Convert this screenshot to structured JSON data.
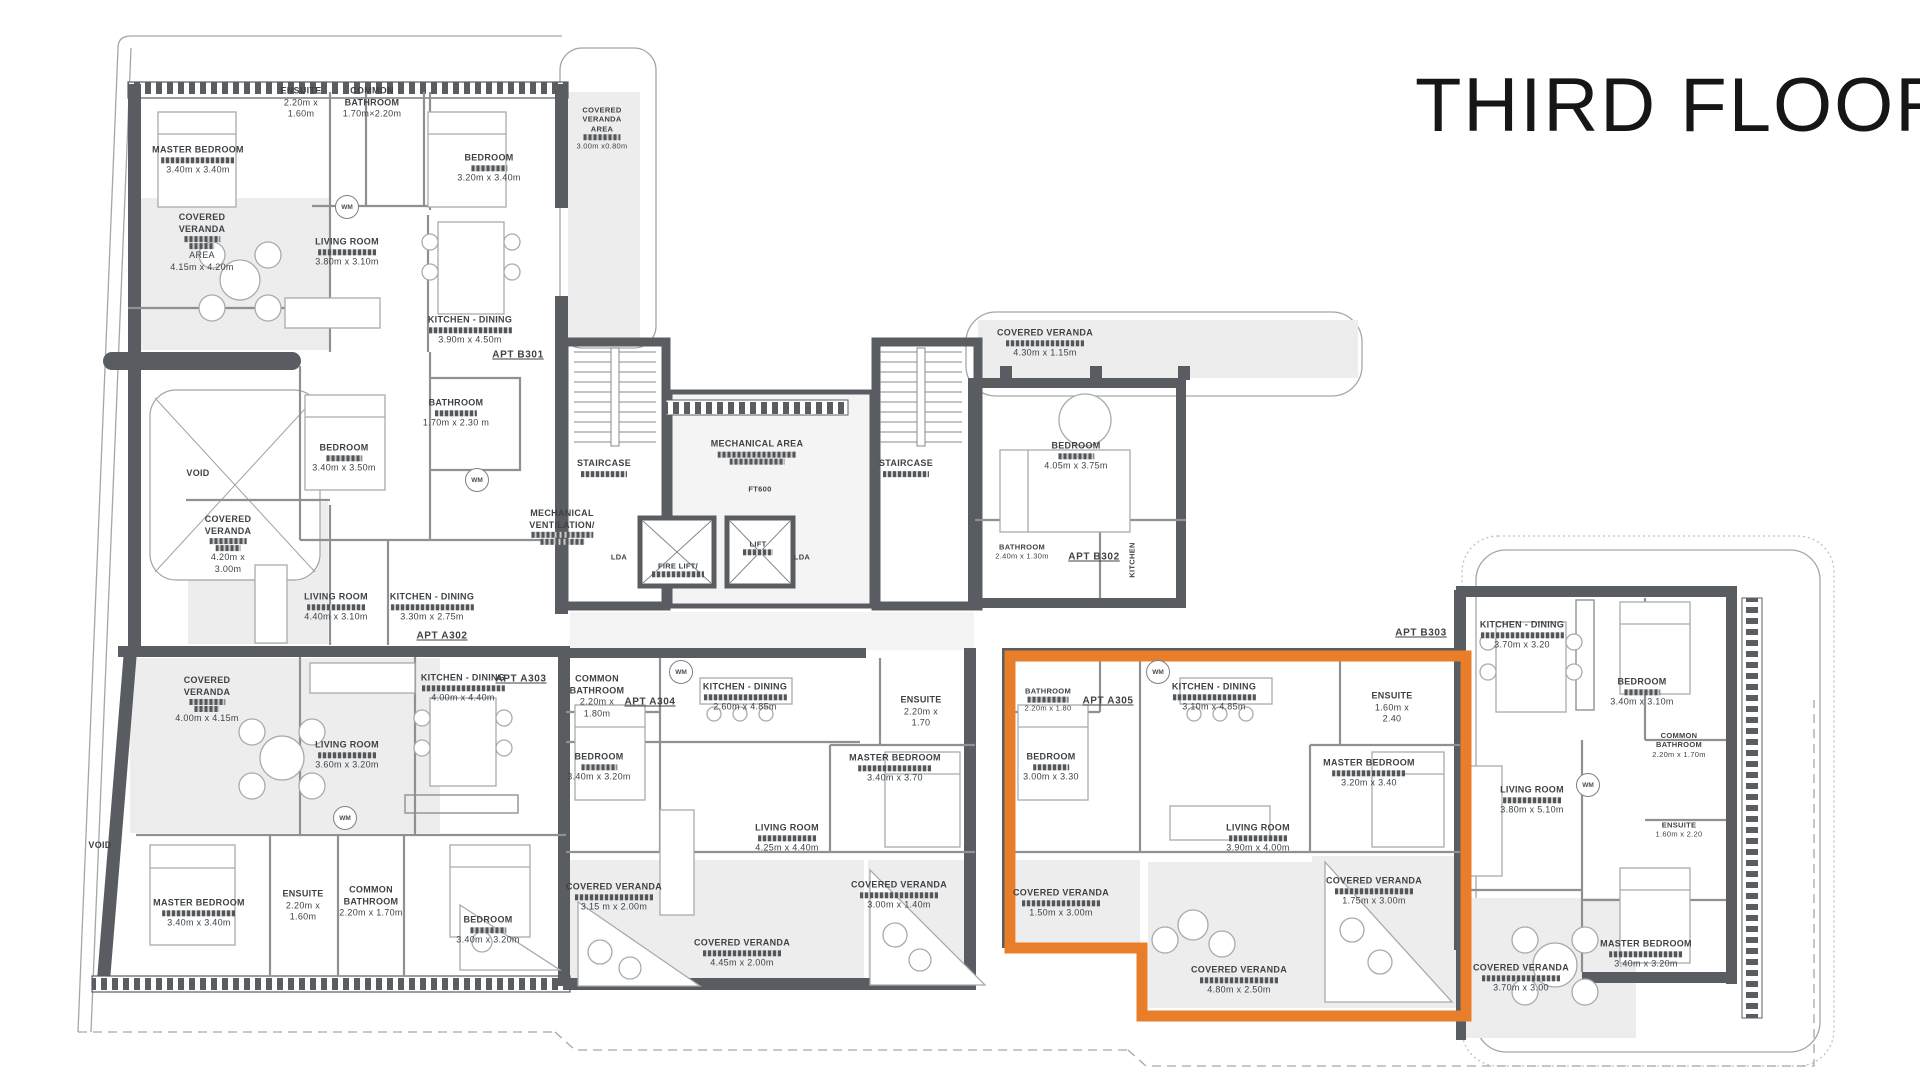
{
  "title": "THIRD FLOOR",
  "colors": {
    "highlight": "#E87E2A",
    "wall": "#595C60",
    "floor": "#EDEDEE",
    "text": "#3F4245"
  },
  "plan": {
    "labels": [
      {
        "id": "b301-master-bedroom",
        "x": 198,
        "y": 160,
        "n": [
          "MASTER BEDROOM"
        ],
        "r": 1,
        "d": [
          "3.40m x 3.40m"
        ]
      },
      {
        "id": "b301-ensuite",
        "x": 301,
        "y": 103,
        "n": [
          "ENSUITE"
        ],
        "r": 0,
        "d": [
          "2.20m x",
          "1.60m"
        ]
      },
      {
        "id": "b301-common-bathroom",
        "x": 372,
        "y": 103,
        "n": [
          "COMMON",
          "BATHROOM"
        ],
        "r": 0,
        "d": [
          "1.70m×2.20m"
        ]
      },
      {
        "id": "b301-bedroom",
        "x": 489,
        "y": 168,
        "n": [
          "BEDROOM"
        ],
        "r": 1,
        "d": [
          "3.20m x 3.40m"
        ]
      },
      {
        "id": "b301-cv-area-east",
        "x": 602,
        "y": 128,
        "n": [
          "COVERED",
          "VERANDA",
          "AREA"
        ],
        "r": 1,
        "d": [
          "3.00m x0.80m"
        ],
        "sz": "s"
      },
      {
        "id": "b301-cv-area",
        "x": 202,
        "y": 243,
        "n": [
          "COVERED",
          "VERANDA"
        ],
        "r": 2,
        "d": [
          "AREA",
          "4.15m x 4.20m"
        ]
      },
      {
        "id": "b301-living-room",
        "x": 347,
        "y": 252,
        "n": [
          "LIVING ROOM"
        ],
        "r": 1,
        "d": [
          "3.80m x 3.10m"
        ]
      },
      {
        "id": "b301-kitchen-dining",
        "x": 470,
        "y": 330,
        "n": [
          "KITCHEN - DINING"
        ],
        "r": 1,
        "d": [
          "3.90m x 4.50m"
        ]
      },
      {
        "id": "apt-b301",
        "x": 518,
        "y": 355,
        "n": [
          "APT B301"
        ],
        "u": 1
      },
      {
        "id": "b301-bathroom",
        "x": 456,
        "y": 413,
        "n": [
          "BATHROOM"
        ],
        "r": 1,
        "d": [
          "1.70m x 2.30 m"
        ]
      },
      {
        "id": "a302-bedroom",
        "x": 344,
        "y": 458,
        "n": [
          "BEDROOM"
        ],
        "r": 1,
        "d": [
          "3.40m x 3.50m"
        ]
      },
      {
        "id": "void-1",
        "x": 198,
        "y": 474,
        "n": [
          "VOID"
        ]
      },
      {
        "id": "a302-cv",
        "x": 228,
        "y": 545,
        "n": [
          "COVERED",
          "VERANDA"
        ],
        "r": 2,
        "d": [
          "4.20m x",
          "3.00m"
        ]
      },
      {
        "id": "a302-living-room",
        "x": 336,
        "y": 607,
        "n": [
          "LIVING ROOM"
        ],
        "r": 1,
        "d": [
          "4.40m x 3.10m"
        ]
      },
      {
        "id": "a302-kitchen-dining",
        "x": 432,
        "y": 607,
        "n": [
          "KITCHEN - DINING"
        ],
        "r": 1,
        "d": [
          "3.30m x 2.75m"
        ]
      },
      {
        "id": "apt-a302",
        "x": 442,
        "y": 636,
        "n": [
          "APT A302"
        ],
        "u": 1
      },
      {
        "id": "a303-cv",
        "x": 207,
        "y": 700,
        "n": [
          "COVERED",
          "VERANDA"
        ],
        "r": 2,
        "d": [
          "4.00m x 4.15m"
        ]
      },
      {
        "id": "a303-living-room",
        "x": 347,
        "y": 755,
        "n": [
          "LIVING ROOM"
        ],
        "r": 1,
        "d": [
          "3.60m x 3.20m"
        ]
      },
      {
        "id": "a303-kitchen-dining",
        "x": 463,
        "y": 688,
        "n": [
          "KITCHEN - DINING"
        ],
        "r": 1,
        "d": [
          "4.00m x 4.40m"
        ]
      },
      {
        "id": "apt-a303",
        "x": 521,
        "y": 679,
        "n": [
          "APT A303"
        ],
        "u": 1
      },
      {
        "id": "a303-master-bedroom",
        "x": 199,
        "y": 913,
        "n": [
          "MASTER BEDROOM"
        ],
        "r": 1,
        "d": [
          "3.40m x 3.40m"
        ]
      },
      {
        "id": "a303-ensuite",
        "x": 303,
        "y": 906,
        "n": [
          "ENSUITE"
        ],
        "r": 0,
        "d": [
          "2.20m x",
          "1.60m"
        ]
      },
      {
        "id": "a303-common-bathroom",
        "x": 371,
        "y": 902,
        "n": [
          "COMMON",
          "BATHROOM"
        ],
        "r": 0,
        "d": [
          "2.20m x 1.70m"
        ]
      },
      {
        "id": "a303-bedroom",
        "x": 488,
        "y": 930,
        "n": [
          "BEDROOM"
        ],
        "r": 1,
        "d": [
          "3.40m x 3.20m"
        ]
      },
      {
        "id": "a304-common-bathroom",
        "x": 597,
        "y": 697,
        "n": [
          "COMMON",
          "BATHROOM"
        ],
        "r": 0,
        "d": [
          "2.20m x",
          "1.80m"
        ]
      },
      {
        "id": "apt-a304",
        "x": 650,
        "y": 702,
        "n": [
          "APT A304"
        ],
        "u": 1
      },
      {
        "id": "a304-kitchen-dining",
        "x": 745,
        "y": 697,
        "n": [
          "KITCHEN - DINING"
        ],
        "r": 1,
        "d": [
          "2.60m x 4.85m"
        ]
      },
      {
        "id": "a304-bedroom",
        "x": 599,
        "y": 767,
        "n": [
          "BEDROOM"
        ],
        "r": 1,
        "d": [
          "3.40m x 3.20m"
        ]
      },
      {
        "id": "a304-master-bedroom",
        "x": 895,
        "y": 768,
        "n": [
          "MASTER BEDROOM"
        ],
        "r": 1,
        "d": [
          "3.40m x 3.70"
        ]
      },
      {
        "id": "a304-ensuite",
        "x": 921,
        "y": 712,
        "n": [
          "ENSUITE"
        ],
        "r": 0,
        "d": [
          "2.20m x",
          "1.70"
        ]
      },
      {
        "id": "a304-living-room",
        "x": 787,
        "y": 838,
        "n": [
          "LIVING ROOM"
        ],
        "r": 1,
        "d": [
          "4.25m x 4.40m"
        ]
      },
      {
        "id": "a304-cv-1",
        "x": 614,
        "y": 897,
        "n": [
          "COVERED VERANDA"
        ],
        "r": 1,
        "d": [
          "3.15 m x 2.00m"
        ]
      },
      {
        "id": "a304-cv-2",
        "x": 742,
        "y": 953,
        "n": [
          "COVERED VERANDA"
        ],
        "r": 1,
        "d": [
          "4.45m x 2.00m"
        ]
      },
      {
        "id": "a304-cv-3",
        "x": 899,
        "y": 895,
        "n": [
          "COVERED VERANDA"
        ],
        "r": 1,
        "d": [
          "3.00m x 1.40m"
        ]
      },
      {
        "id": "a305-bathroom",
        "x": 1048,
        "y": 700,
        "n": [
          "BATHROOM"
        ],
        "r": 1,
        "d": [
          "2.20m x 1.80"
        ],
        "sz": "s"
      },
      {
        "id": "apt-a305",
        "x": 1108,
        "y": 701,
        "n": [
          "APT A305"
        ],
        "u": 1
      },
      {
        "id": "a305-kitchen-dining",
        "x": 1214,
        "y": 697,
        "n": [
          "KITCHEN - DINING"
        ],
        "r": 1,
        "d": [
          "3.10m x 4.85m"
        ]
      },
      {
        "id": "a305-ensuite",
        "x": 1392,
        "y": 708,
        "n": [
          "ENSUITE"
        ],
        "r": 0,
        "d": [
          "1.60m x",
          "2.40"
        ]
      },
      {
        "id": "a305-bedroom",
        "x": 1051,
        "y": 767,
        "n": [
          "BEDROOM"
        ],
        "r": 1,
        "d": [
          "3.00m x 3.30"
        ]
      },
      {
        "id": "a305-master-bedroom",
        "x": 1369,
        "y": 773,
        "n": [
          "MASTER BEDROOM"
        ],
        "r": 1,
        "d": [
          "3.20m x 3.40"
        ]
      },
      {
        "id": "a305-living-room",
        "x": 1258,
        "y": 838,
        "n": [
          "LIVING ROOM"
        ],
        "r": 1,
        "d": [
          "3.90m x 4.00m"
        ]
      },
      {
        "id": "a305-cv-1",
        "x": 1061,
        "y": 903,
        "n": [
          "COVERED VERANDA"
        ],
        "r": 1,
        "d": [
          "1.50m x 3.00m"
        ]
      },
      {
        "id": "a305-cv-2",
        "x": 1374,
        "y": 891,
        "n": [
          "COVERED VERANDA"
        ],
        "r": 1,
        "d": [
          "1.75m x 3.00m"
        ]
      },
      {
        "id": "a305-cv-3",
        "x": 1239,
        "y": 980,
        "n": [
          "COVERED VERANDA"
        ],
        "r": 1,
        "d": [
          "4.80m x 2.50m"
        ]
      },
      {
        "id": "b302-cv",
        "x": 1045,
        "y": 343,
        "n": [
          "COVERED VERANDA"
        ],
        "r": 1,
        "d": [
          "4.30m x 1.15m"
        ]
      },
      {
        "id": "b302-bedroom",
        "x": 1076,
        "y": 456,
        "n": [
          "BEDROOM"
        ],
        "r": 1,
        "d": [
          "4.05m x 3.75m"
        ]
      },
      {
        "id": "b302-bathroom",
        "x": 1022,
        "y": 552,
        "n": [
          "BATHROOM"
        ],
        "r": 0,
        "d": [
          "2.40m x 1.30m"
        ],
        "sz": "s"
      },
      {
        "id": "apt-b302",
        "x": 1094,
        "y": 557,
        "n": [
          "APT B302"
        ],
        "u": 1
      },
      {
        "id": "b302-kitchen",
        "x": 1132,
        "y": 560,
        "n": [
          "KITCHEN"
        ],
        "rot": 1,
        "sz": "s"
      },
      {
        "id": "b303-kitchen-dining",
        "x": 1522,
        "y": 635,
        "n": [
          "KITCHEN - DINING"
        ],
        "r": 1,
        "d": [
          "3.70m x 3.20"
        ]
      },
      {
        "id": "apt-b303",
        "x": 1421,
        "y": 633,
        "n": [
          "APT B303"
        ],
        "u": 1
      },
      {
        "id": "b303-bedroom",
        "x": 1642,
        "y": 692,
        "n": [
          "BEDROOM"
        ],
        "r": 1,
        "d": [
          "3.40m x 3.10m"
        ]
      },
      {
        "id": "b303-common-bathroom",
        "x": 1679,
        "y": 745,
        "n": [
          "COMMON",
          "BATHROOM"
        ],
        "r": 0,
        "d": [
          "2.20m x 1.70m"
        ],
        "sz": "s"
      },
      {
        "id": "b303-living-room",
        "x": 1532,
        "y": 800,
        "n": [
          "LIVING ROOM"
        ],
        "r": 1,
        "d": [
          "3.80m x 5.10m"
        ]
      },
      {
        "id": "b303-ensuite",
        "x": 1679,
        "y": 830,
        "n": [
          "ENSUITE"
        ],
        "r": 0,
        "d": [
          "1.60m x 2.20"
        ],
        "sz": "s"
      },
      {
        "id": "b303-master-bedroom",
        "x": 1646,
        "y": 954,
        "n": [
          "MASTER BEDROOM"
        ],
        "r": 1,
        "d": [
          "3.40m x 3.20m"
        ]
      },
      {
        "id": "b303-cv",
        "x": 1521,
        "y": 978,
        "n": [
          "COVERED VERANDA"
        ],
        "r": 1,
        "d": [
          "3.70m x 3.00"
        ]
      },
      {
        "id": "staircase-1",
        "x": 604,
        "y": 468,
        "n": [
          "STAIRCASE"
        ],
        "r": 1
      },
      {
        "id": "staircase-2",
        "x": 906,
        "y": 468,
        "n": [
          "STAIRCASE"
        ],
        "r": 1
      },
      {
        "id": "mechanical-area",
        "x": 757,
        "y": 452,
        "n": [
          "MECHANICAL AREA"
        ],
        "r": 2
      },
      {
        "id": "ft600",
        "x": 760,
        "y": 489,
        "n": [
          "FT600"
        ],
        "sz": "s"
      },
      {
        "id": "mechanical-ventilation",
        "x": 562,
        "y": 527,
        "n": [
          "MECHANICAL",
          "VENTILATION/"
        ],
        "r": 2
      },
      {
        "id": "lda-1",
        "x": 619,
        "y": 557,
        "n": [
          "LDA"
        ],
        "sz": "s"
      },
      {
        "id": "lda-2",
        "x": 802,
        "y": 557,
        "n": [
          "LDA"
        ],
        "sz": "s"
      },
      {
        "id": "fire-lift",
        "x": 678,
        "y": 570,
        "n": [
          "FIRE LIFT/"
        ],
        "r": 1,
        "sz": "s"
      },
      {
        "id": "lift",
        "x": 758,
        "y": 548,
        "n": [
          "LIFT"
        ],
        "r": 1,
        "sz": "s"
      },
      {
        "id": "void-2",
        "x": 100,
        "y": 846,
        "n": [
          "VOID"
        ]
      }
    ],
    "wm_badges": [
      {
        "x": 347,
        "y": 207
      },
      {
        "x": 477,
        "y": 480
      },
      {
        "x": 681,
        "y": 672
      },
      {
        "x": 1158,
        "y": 672
      },
      {
        "x": 345,
        "y": 818
      },
      {
        "x": 1588,
        "y": 785
      }
    ],
    "wm_text": "WM"
  }
}
